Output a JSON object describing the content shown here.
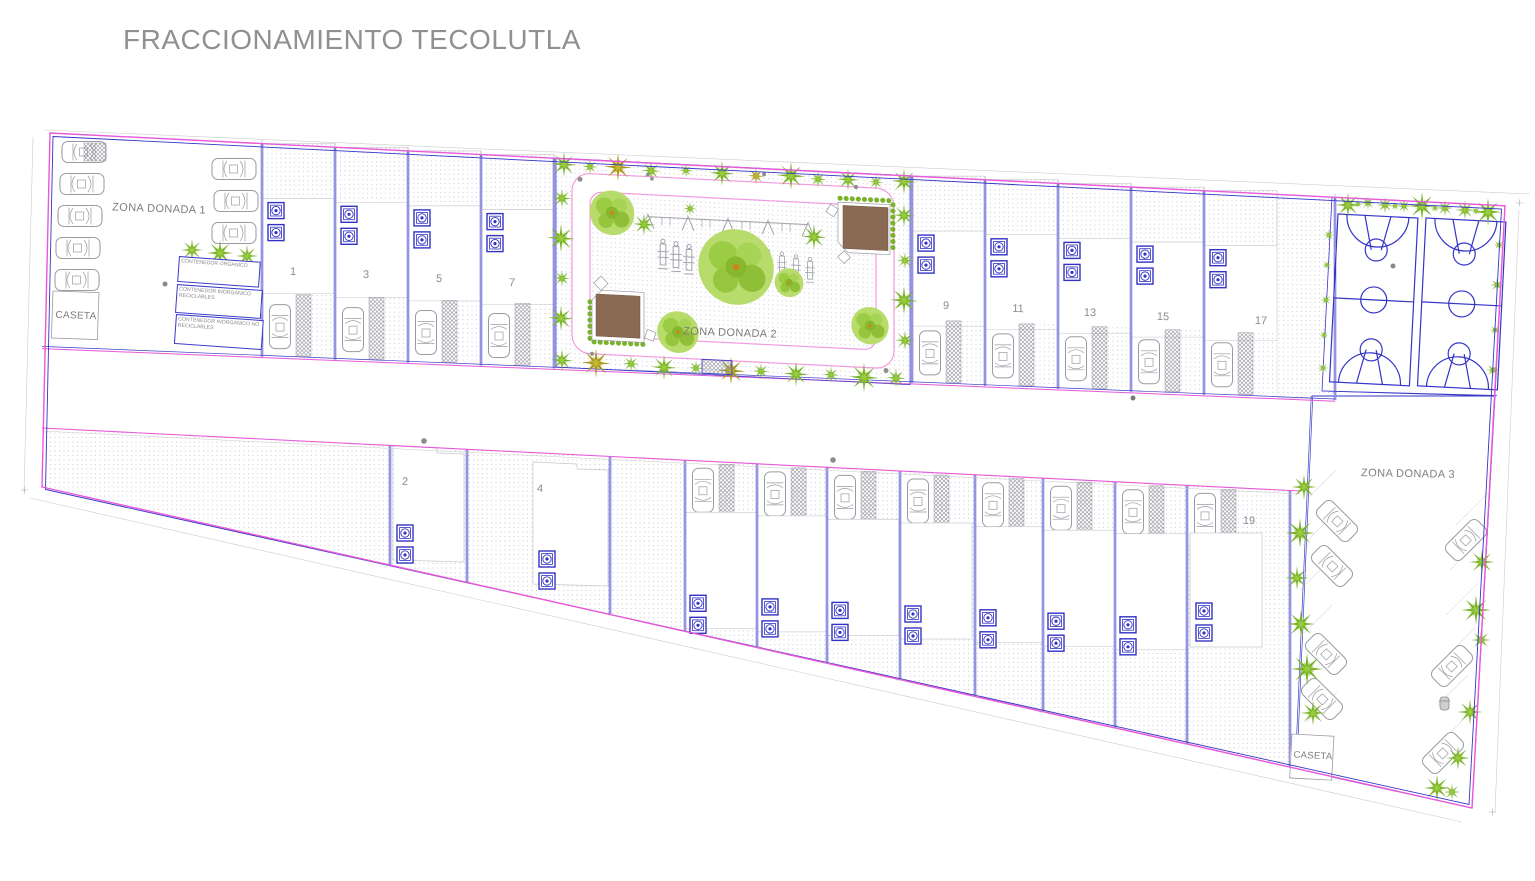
{
  "title": "FRACCIONAMIENTO TECOLUTLA",
  "zones": {
    "zona_donada_1": {
      "label": "ZONA DONADA 1"
    },
    "zona_donada_2": {
      "label": "ZONA DONADA 2"
    },
    "zona_donada_3": {
      "label": "ZONA DONADA 3"
    },
    "caseta_nw": {
      "label": "CASETA"
    },
    "caseta_se": {
      "label": "CASETA"
    }
  },
  "waste_containers": [
    {
      "label": "CONTENEDOR ORGANICO"
    },
    {
      "label": "CONTENEDOR INORGANICO RECICLABLES"
    },
    {
      "label": "CONTENEDOR INORGANICO NO RECICLABLES"
    }
  ],
  "lots": {
    "north_row": [
      {
        "label": "1"
      },
      {
        "label": "3"
      },
      {
        "label": "5"
      },
      {
        "label": "7"
      },
      {
        "label": "9"
      },
      {
        "label": "11"
      },
      {
        "label": "13"
      },
      {
        "label": "15"
      },
      {
        "label": "17"
      }
    ],
    "south_row": [
      {
        "label": "2"
      },
      {
        "label": "4"
      },
      {
        "label": "19"
      }
    ]
  },
  "features": {
    "basketball_courts": 2,
    "park_pavilions": 2
  },
  "colors": {
    "boundary_magenta": "#e858d8",
    "parcel_blue": "#3838c8",
    "vegetation_green": "#7ab22c",
    "pavilion_brown": "#8a6a52",
    "title_gray": "#909090"
  }
}
